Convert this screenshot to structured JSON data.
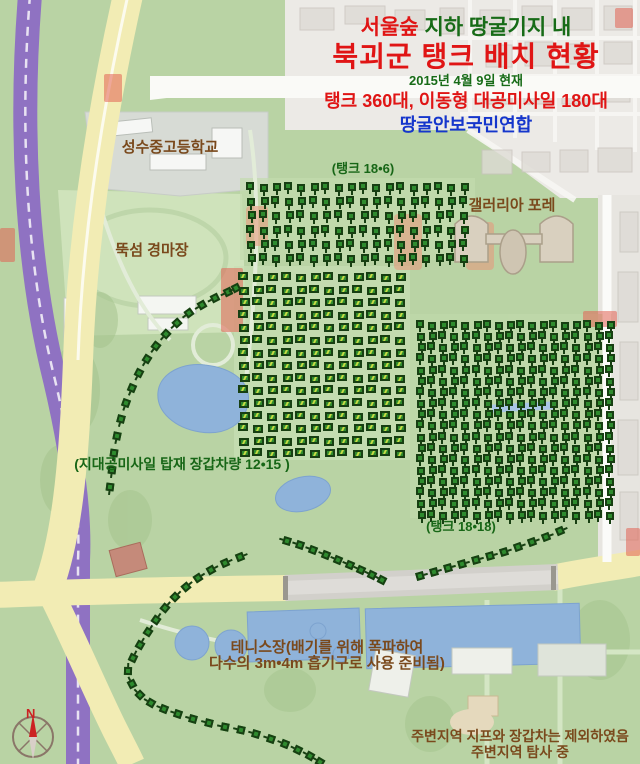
{
  "title": {
    "line1_red": "서울숲",
    "line1_rest": " 지하 땅굴기지 내",
    "line2": "북괴군 탱크 배치 현황",
    "line3": "2015년 4월 9일 현재",
    "line4": "탱크 360대, 이동형 대공미사일 180대",
    "line5": "땅굴안보국민연합"
  },
  "map_labels": {
    "school": "성수중고등학교",
    "galleria": "갤러리아 포레",
    "racetrack": "뚝섬 경마장",
    "tank_grid_top": "(탱크 18•6)",
    "sam_grid": "(지대공미사일 탑재 장갑차량 12•15 )",
    "tank_grid_right": "(탱크 18•18)",
    "tennis_line1": "테니스장(배기를 위해 폭파하여",
    "tennis_line2": "다수의 3m•4m 흡기구로 사용 준비됨)",
    "note_line1": "주변지역 지프와 장갑차는 제외하였음",
    "note_line2": "주변지역 탐사 중",
    "compass_n": "N"
  },
  "colors": {
    "title_red": "#e01515",
    "title_green": "#176b17",
    "title_blue": "#1536cc",
    "label_brown": "#7a491c",
    "label_green": "#176616",
    "tank_green": "#2e8b2e",
    "tank_dark": "#173f12",
    "apc_slash": "#c8dd46",
    "marker_red": "#e26254",
    "water_blue": "#8fb3da",
    "road_yellow": "#f2ecb4",
    "rail_purple": "#8f72c2",
    "park_green": "#b9d3a4"
  },
  "units": {
    "grids": [
      {
        "name": "tank-grid-18x6",
        "type": "tank",
        "cols": 18,
        "rows": 6,
        "x": 247,
        "y": 183,
        "dx": 12.5,
        "dy": 14.2
      },
      {
        "name": "sam-grid-12x15",
        "type": "apc",
        "cols": 12,
        "rows": 15,
        "x": 239,
        "y": 273,
        "dx": 14.2,
        "dy": 12.6
      },
      {
        "name": "tank-grid-18x18",
        "type": "tank",
        "cols": 18,
        "rows": 18,
        "x": 417,
        "y": 321,
        "dx": 11.1,
        "dy": 11.15
      }
    ],
    "convoys": [
      {
        "name": "convoy-west-arc",
        "points": [
          [
            110,
            487
          ],
          [
            112,
            470
          ],
          [
            114,
            453
          ],
          [
            117,
            436
          ],
          [
            121,
            419
          ],
          [
            126,
            403
          ],
          [
            132,
            388
          ],
          [
            139,
            373
          ],
          [
            147,
            359
          ],
          [
            156,
            346
          ],
          [
            166,
            334
          ],
          [
            177,
            323
          ],
          [
            189,
            313
          ],
          [
            202,
            305
          ],
          [
            215,
            298
          ],
          [
            228,
            292
          ],
          [
            236,
            288
          ]
        ]
      },
      {
        "name": "convoy-road-east",
        "points": [
          [
            560,
            531
          ],
          [
            546,
            537
          ],
          [
            532,
            542
          ],
          [
            518,
            547
          ],
          [
            504,
            552
          ],
          [
            490,
            556
          ],
          [
            476,
            560
          ],
          [
            462,
            564
          ],
          [
            448,
            568
          ],
          [
            434,
            572
          ],
          [
            420,
            576
          ]
        ]
      },
      {
        "name": "convoy-mid-diagonal",
        "points": [
          [
            287,
            541
          ],
          [
            300,
            545
          ],
          [
            313,
            550
          ],
          [
            326,
            555
          ],
          [
            338,
            560
          ],
          [
            350,
            565
          ],
          [
            361,
            570
          ],
          [
            372,
            575
          ],
          [
            382,
            580
          ]
        ]
      },
      {
        "name": "convoy-south-loop",
        "points": [
          [
            240,
            557
          ],
          [
            225,
            563
          ],
          [
            211,
            570
          ],
          [
            198,
            578
          ],
          [
            186,
            587
          ],
          [
            175,
            597
          ],
          [
            165,
            608
          ],
          [
            156,
            620
          ],
          [
            148,
            632
          ],
          [
            140,
            645
          ],
          [
            133,
            658
          ],
          [
            128,
            671
          ],
          [
            132,
            684
          ],
          [
            140,
            695
          ],
          [
            151,
            703
          ],
          [
            164,
            709
          ],
          [
            178,
            714
          ],
          [
            193,
            719
          ],
          [
            209,
            723
          ],
          [
            225,
            727
          ],
          [
            241,
            730
          ],
          [
            256,
            734
          ],
          [
            271,
            739
          ],
          [
            285,
            744
          ],
          [
            298,
            750
          ],
          [
            310,
            756
          ],
          [
            320,
            762
          ]
        ]
      }
    ]
  },
  "red_markers": [
    [
      104,
      74,
      18,
      28
    ],
    [
      0,
      228,
      15,
      34
    ],
    [
      221,
      268,
      22,
      64
    ],
    [
      583,
      311,
      34,
      16
    ],
    [
      626,
      528,
      14,
      28
    ],
    [
      615,
      8,
      18,
      20
    ]
  ]
}
